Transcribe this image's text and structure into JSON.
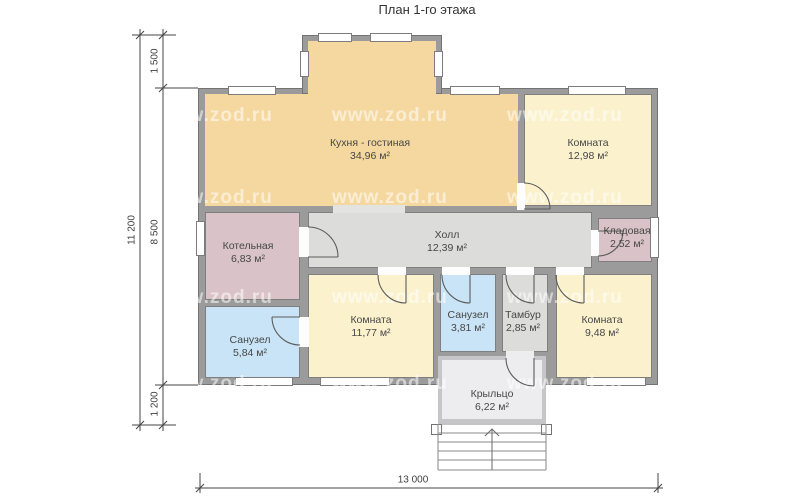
{
  "title": "План 1-го этажа",
  "watermark": {
    "text": "www.zod.ru"
  },
  "rooms": [
    {
      "id": "kitchen-living",
      "name": "Кухня - гостиная",
      "area": "34,96 м²"
    },
    {
      "id": "room-12-98",
      "name": "Комната",
      "area": "12,98 м²"
    },
    {
      "id": "boiler",
      "name": "Котельная",
      "area": "6,83 м²"
    },
    {
      "id": "hall",
      "name": "Холл",
      "area": "12,39 м²"
    },
    {
      "id": "storage",
      "name": "Кладовая",
      "area": "2,52 м²"
    },
    {
      "id": "bath-5-84",
      "name": "Санузел",
      "area": "5,84 м²"
    },
    {
      "id": "room-11-77",
      "name": "Комната",
      "area": "11,77 м²"
    },
    {
      "id": "bath-3-81",
      "name": "Санузел",
      "area": "3,81 м²"
    },
    {
      "id": "tambour",
      "name": "Тамбур",
      "area": "2,85 м²"
    },
    {
      "id": "room-9-48",
      "name": "Комната",
      "area": "9,48 м²"
    },
    {
      "id": "porch",
      "name": "Крыльцо",
      "area": "6,22 м²"
    }
  ],
  "dimensions": {
    "total_height": "11 200",
    "bay_depth": "1 500",
    "main_height": "8 500",
    "porch_depth": "1 200",
    "total_width": "13 000"
  },
  "palette": {
    "wall": "#9B9B9B",
    "kitchen": "#F5D89F",
    "room_cream": "#FBF2CD",
    "utility_mauve": "#D9C3C8",
    "bathroom_blue": "#C9E4F6",
    "hall_gray": "#DCDCDB",
    "porch_gray": "#EDEDEF",
    "window": "#FFFFFF"
  }
}
